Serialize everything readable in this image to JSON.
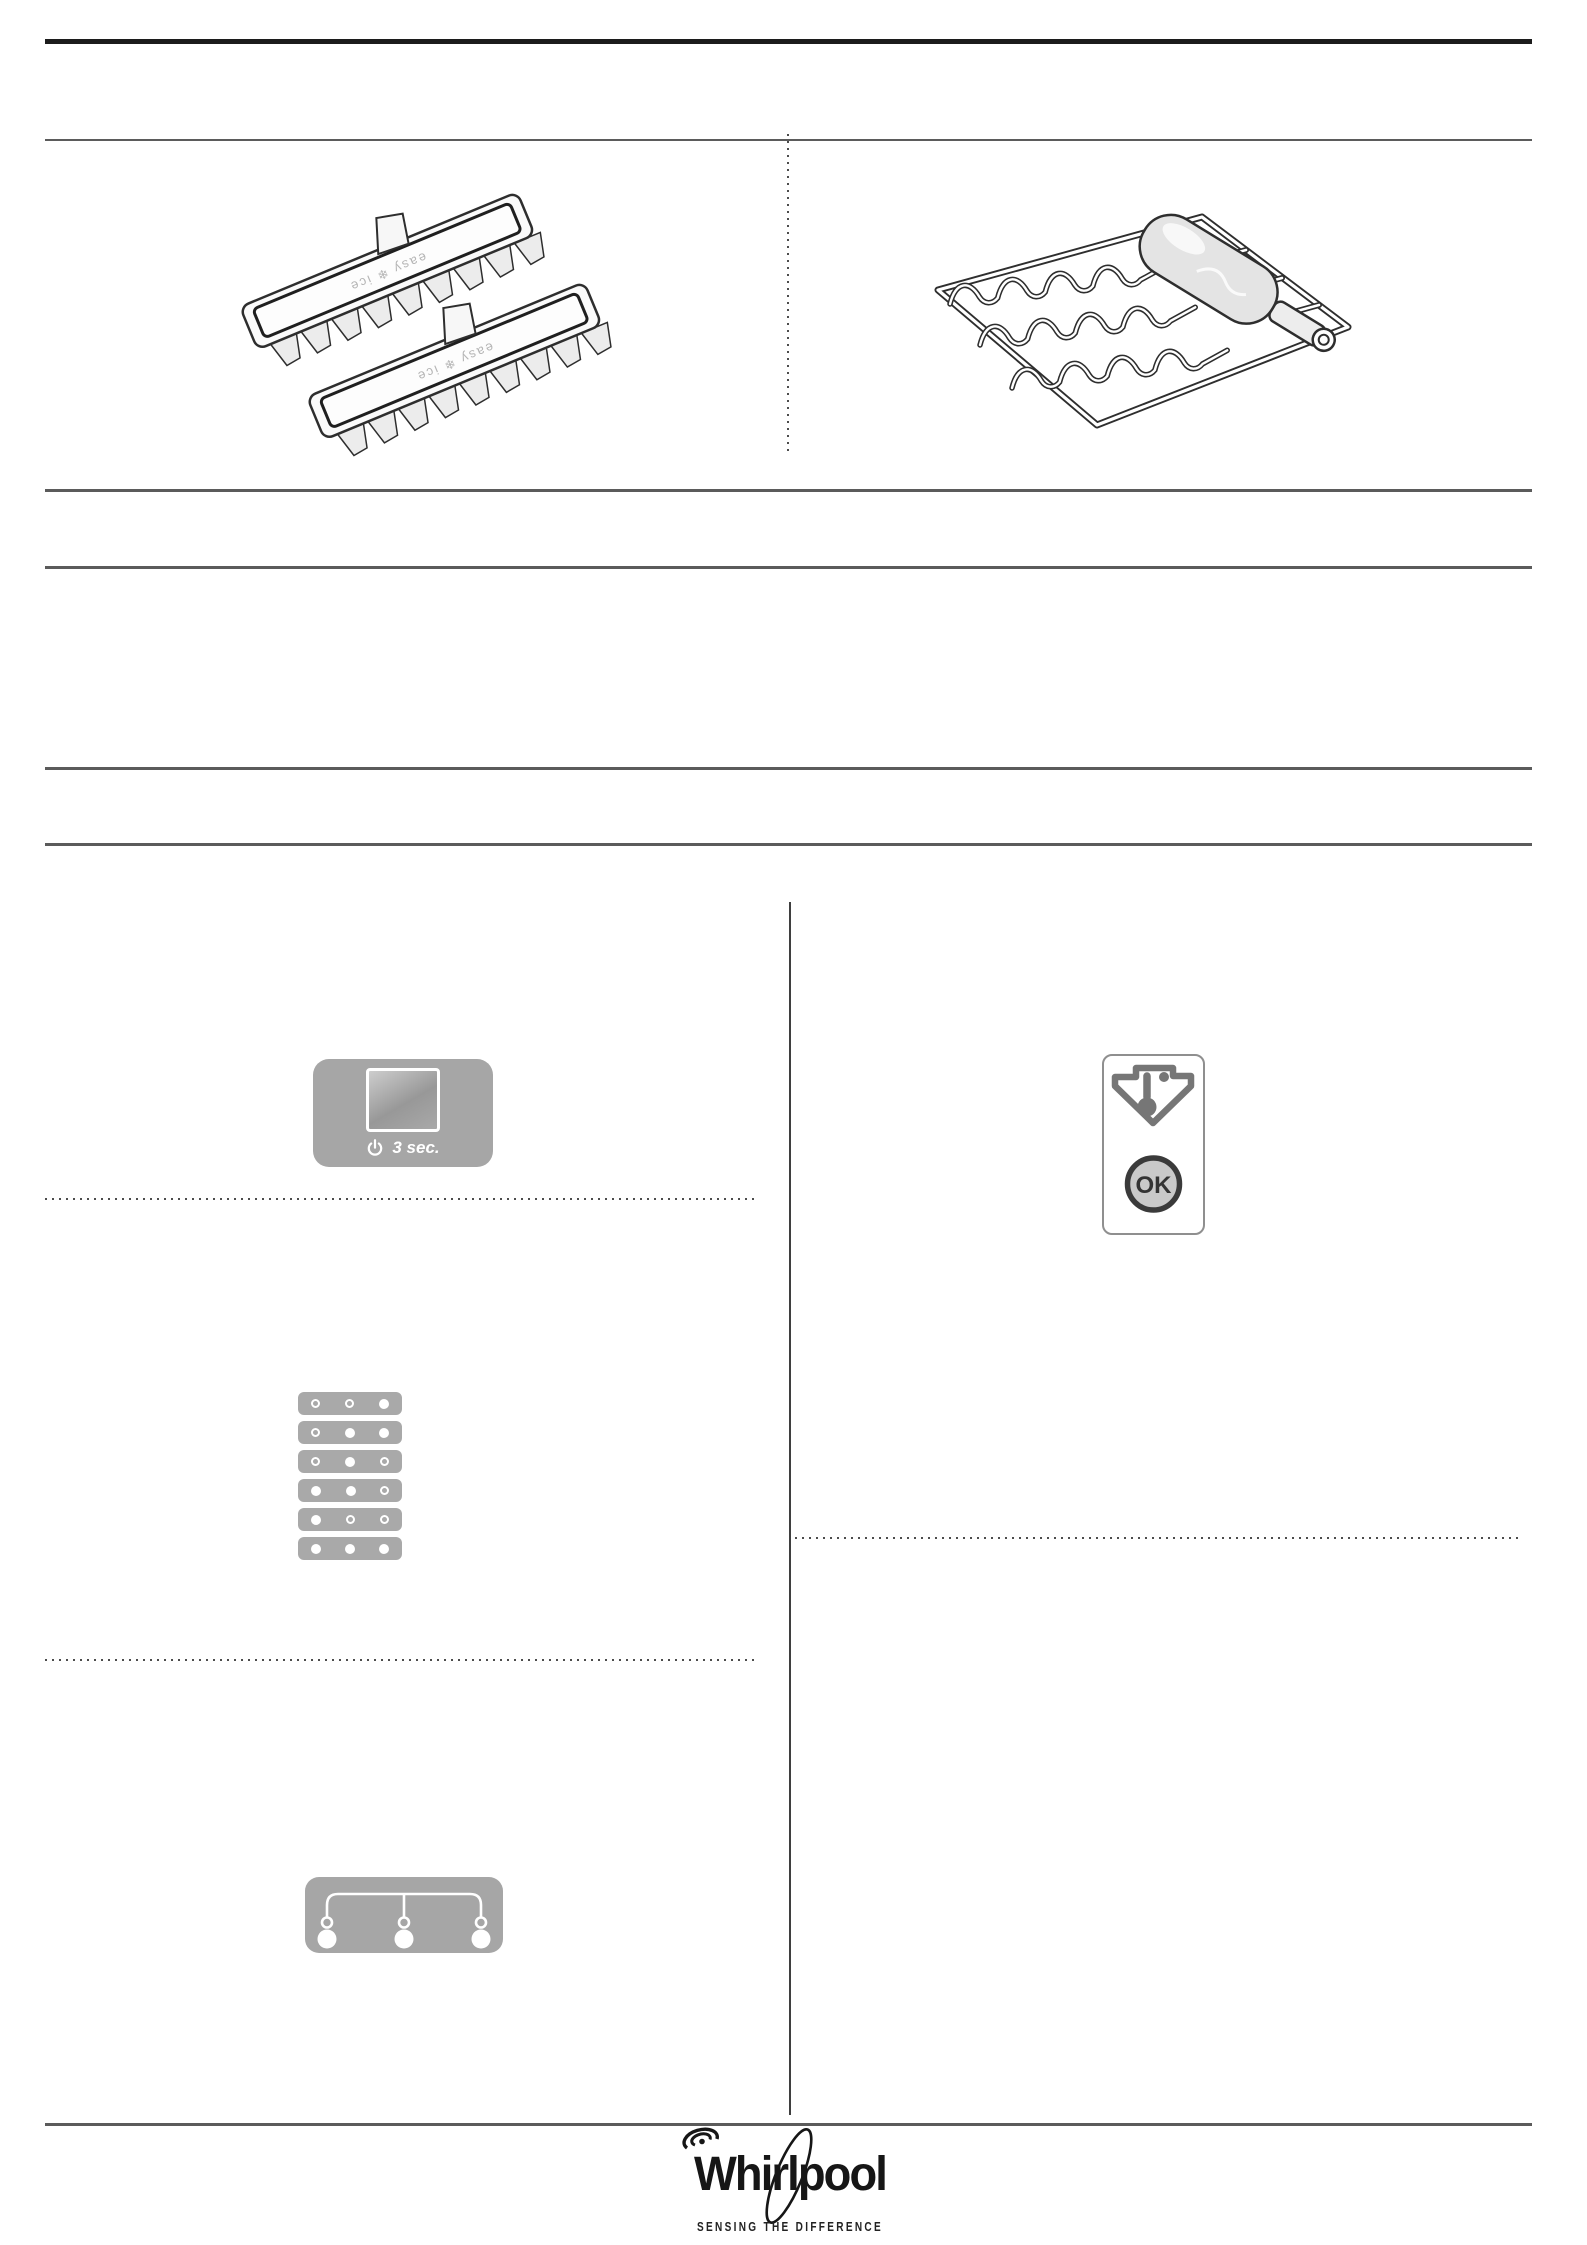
{
  "page": {
    "background": "#ffffff"
  },
  "rules": {
    "top_thick_color": "#1c1c1c",
    "gray_color": "#5b5b5b"
  },
  "illustrations": {
    "ice_trays": {
      "label": "easy ❄ ice",
      "count": 2
    },
    "wine_rack": {
      "items": [
        "wire-rack",
        "bottle"
      ]
    }
  },
  "controls": {
    "power_panel": {
      "icon": "power-icon",
      "label": "3 sec."
    },
    "preset_rows": {
      "rows": [
        [
          "hollow",
          "hollow",
          "filled"
        ],
        [
          "hollow",
          "filled",
          "filled"
        ],
        [
          "hollow",
          "filled",
          "hollow"
        ],
        [
          "filled",
          "filled",
          "hollow"
        ],
        [
          "filled",
          "hollow",
          "hollow"
        ],
        [
          "filled",
          "filled",
          "filled"
        ]
      ]
    },
    "connector_panel": {
      "small_circles": 3,
      "large_circles": 3
    },
    "ok_card": {
      "icon": "temperature-down-arrow-icon",
      "ok_label": "OK"
    }
  },
  "footer": {
    "brand": "Whirlpool",
    "tagline": "SENSING THE DIFFERENCE"
  },
  "colors": {
    "panel_gray": "#a6a6a6",
    "row_gray": "#a9a9a9",
    "line_art": "#2e2e2e",
    "logo_black": "#161616"
  }
}
